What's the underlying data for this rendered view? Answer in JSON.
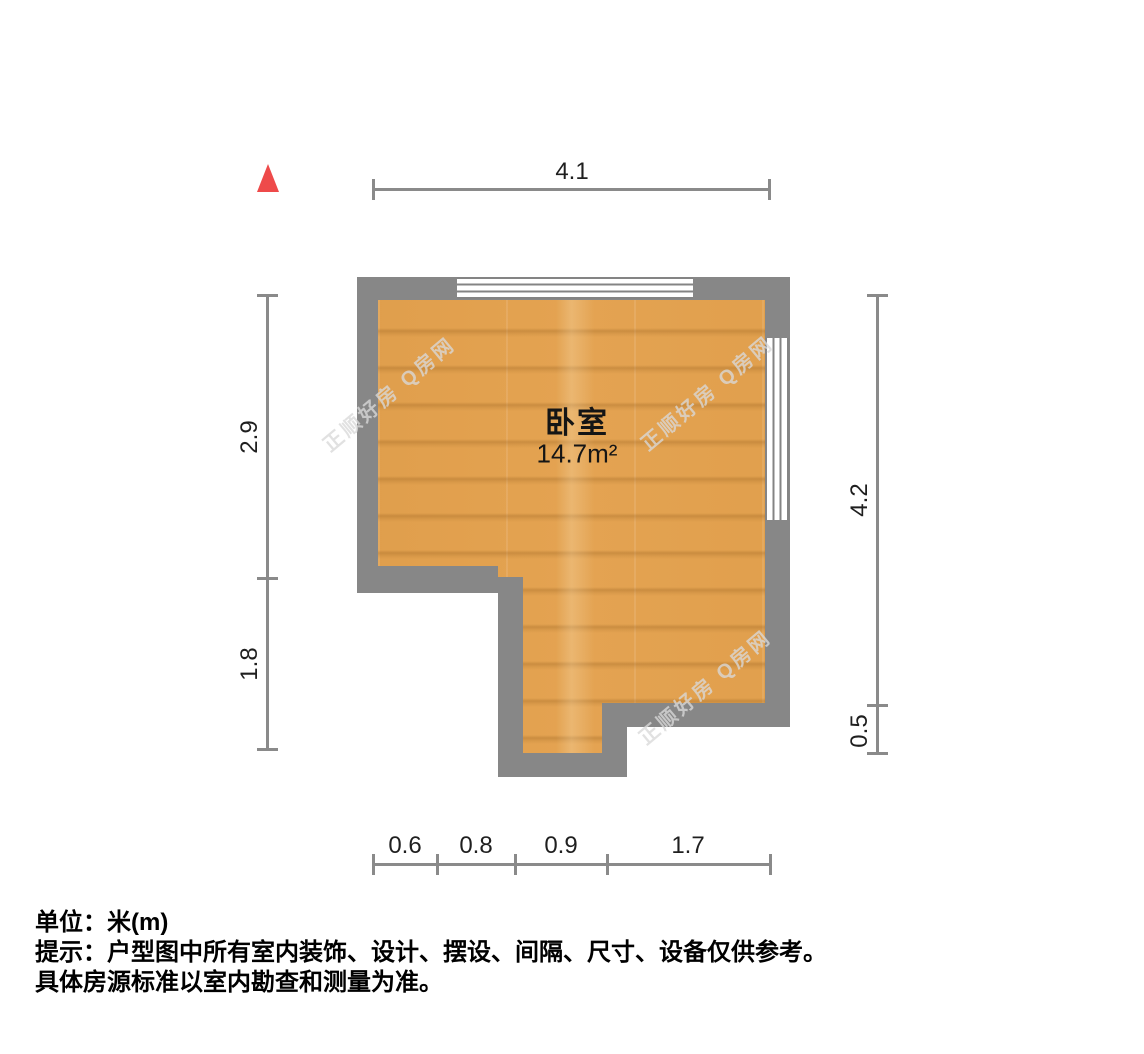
{
  "floor_plan": {
    "room": {
      "name": "卧室",
      "area": "14.7m²"
    },
    "dimensions": {
      "top": [
        {
          "label": "4.1"
        }
      ],
      "left": [
        {
          "label": "2.9"
        },
        {
          "label": "1.8"
        }
      ],
      "right": [
        {
          "label": "4.2"
        },
        {
          "label": "0.5"
        }
      ],
      "bottom": [
        {
          "label": "0.6"
        },
        {
          "label": "0.8"
        },
        {
          "label": "0.9"
        },
        {
          "label": "1.7"
        }
      ]
    },
    "colors": {
      "wall": "#878787",
      "floor_wood": "#e2a14f",
      "north_arrow": "#ee4a4a",
      "dimension_line": "#8a8a8a"
    }
  },
  "watermark": {
    "text": "正顺好房 Q房网"
  },
  "notes": {
    "unit_line": "单位：米(m)",
    "tip_line1": "提示：户型图中所有室内装饰、设计、摆设、间隔、尺寸、设备仅供参考。",
    "tip_line2": "具体房源标准以室内勘查和测量为准。"
  }
}
